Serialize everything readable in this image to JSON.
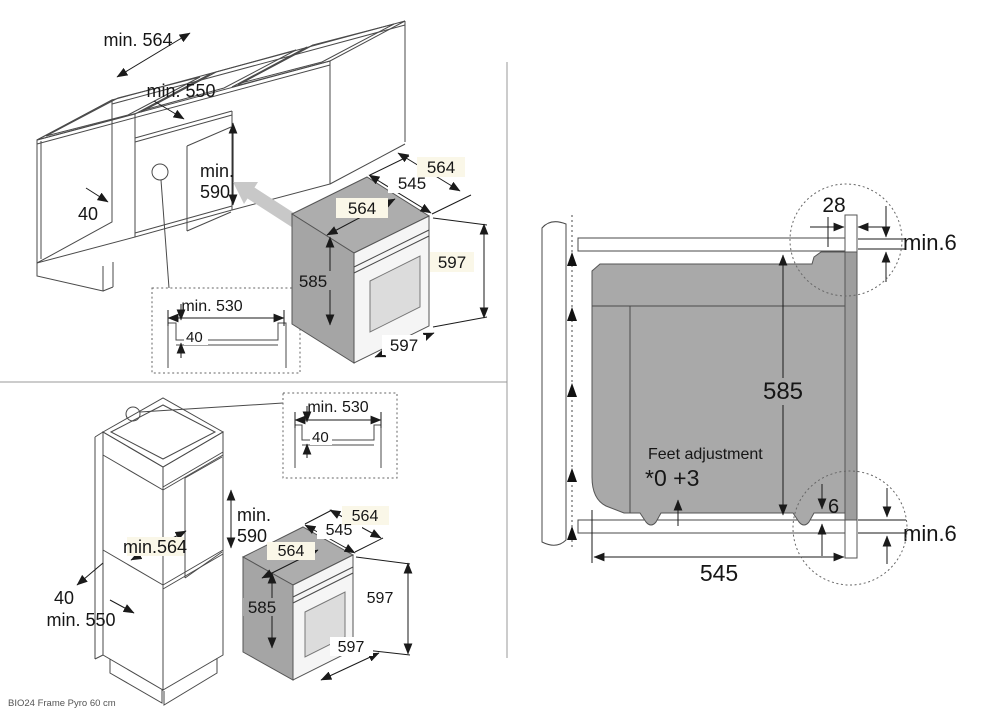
{
  "product_label": "BIO24 Frame Pyro 60 cm",
  "colors": {
    "oven_gray": "#a9a9a9",
    "oven_gray_dark": "#a5a5a5",
    "frame_gray": "#9e9e9e",
    "arrow_gray": "#c8c8c8",
    "highlight_cream": "#faf7e8",
    "line": "#4a4a4a"
  },
  "oven": {
    "width_top": "564",
    "depth_body": "545",
    "depth_total": "564",
    "height_body": "585",
    "height_front": "597",
    "width_front": "597"
  },
  "inset_detail": {
    "width": "min. 530",
    "recess": "40"
  },
  "base_unit": {
    "niche_width": "min. 564",
    "niche_depth": "min. 550",
    "niche_height_top": "min.",
    "niche_height_val": "590",
    "front_rail": "40"
  },
  "tall_unit": {
    "niche_width": "min.564",
    "niche_depth": "min. 550",
    "niche_height_top": "min.",
    "niche_height_val": "590",
    "front_rail": "40"
  },
  "side_view": {
    "frame_overlap": "28",
    "top_clearance": "min.6",
    "oven_height": "585",
    "feet_label": "Feet adjustment",
    "feet_range": "*0 +3",
    "bottom_gap": "6",
    "bottom_clearance": "min.6",
    "oven_depth": "545"
  }
}
